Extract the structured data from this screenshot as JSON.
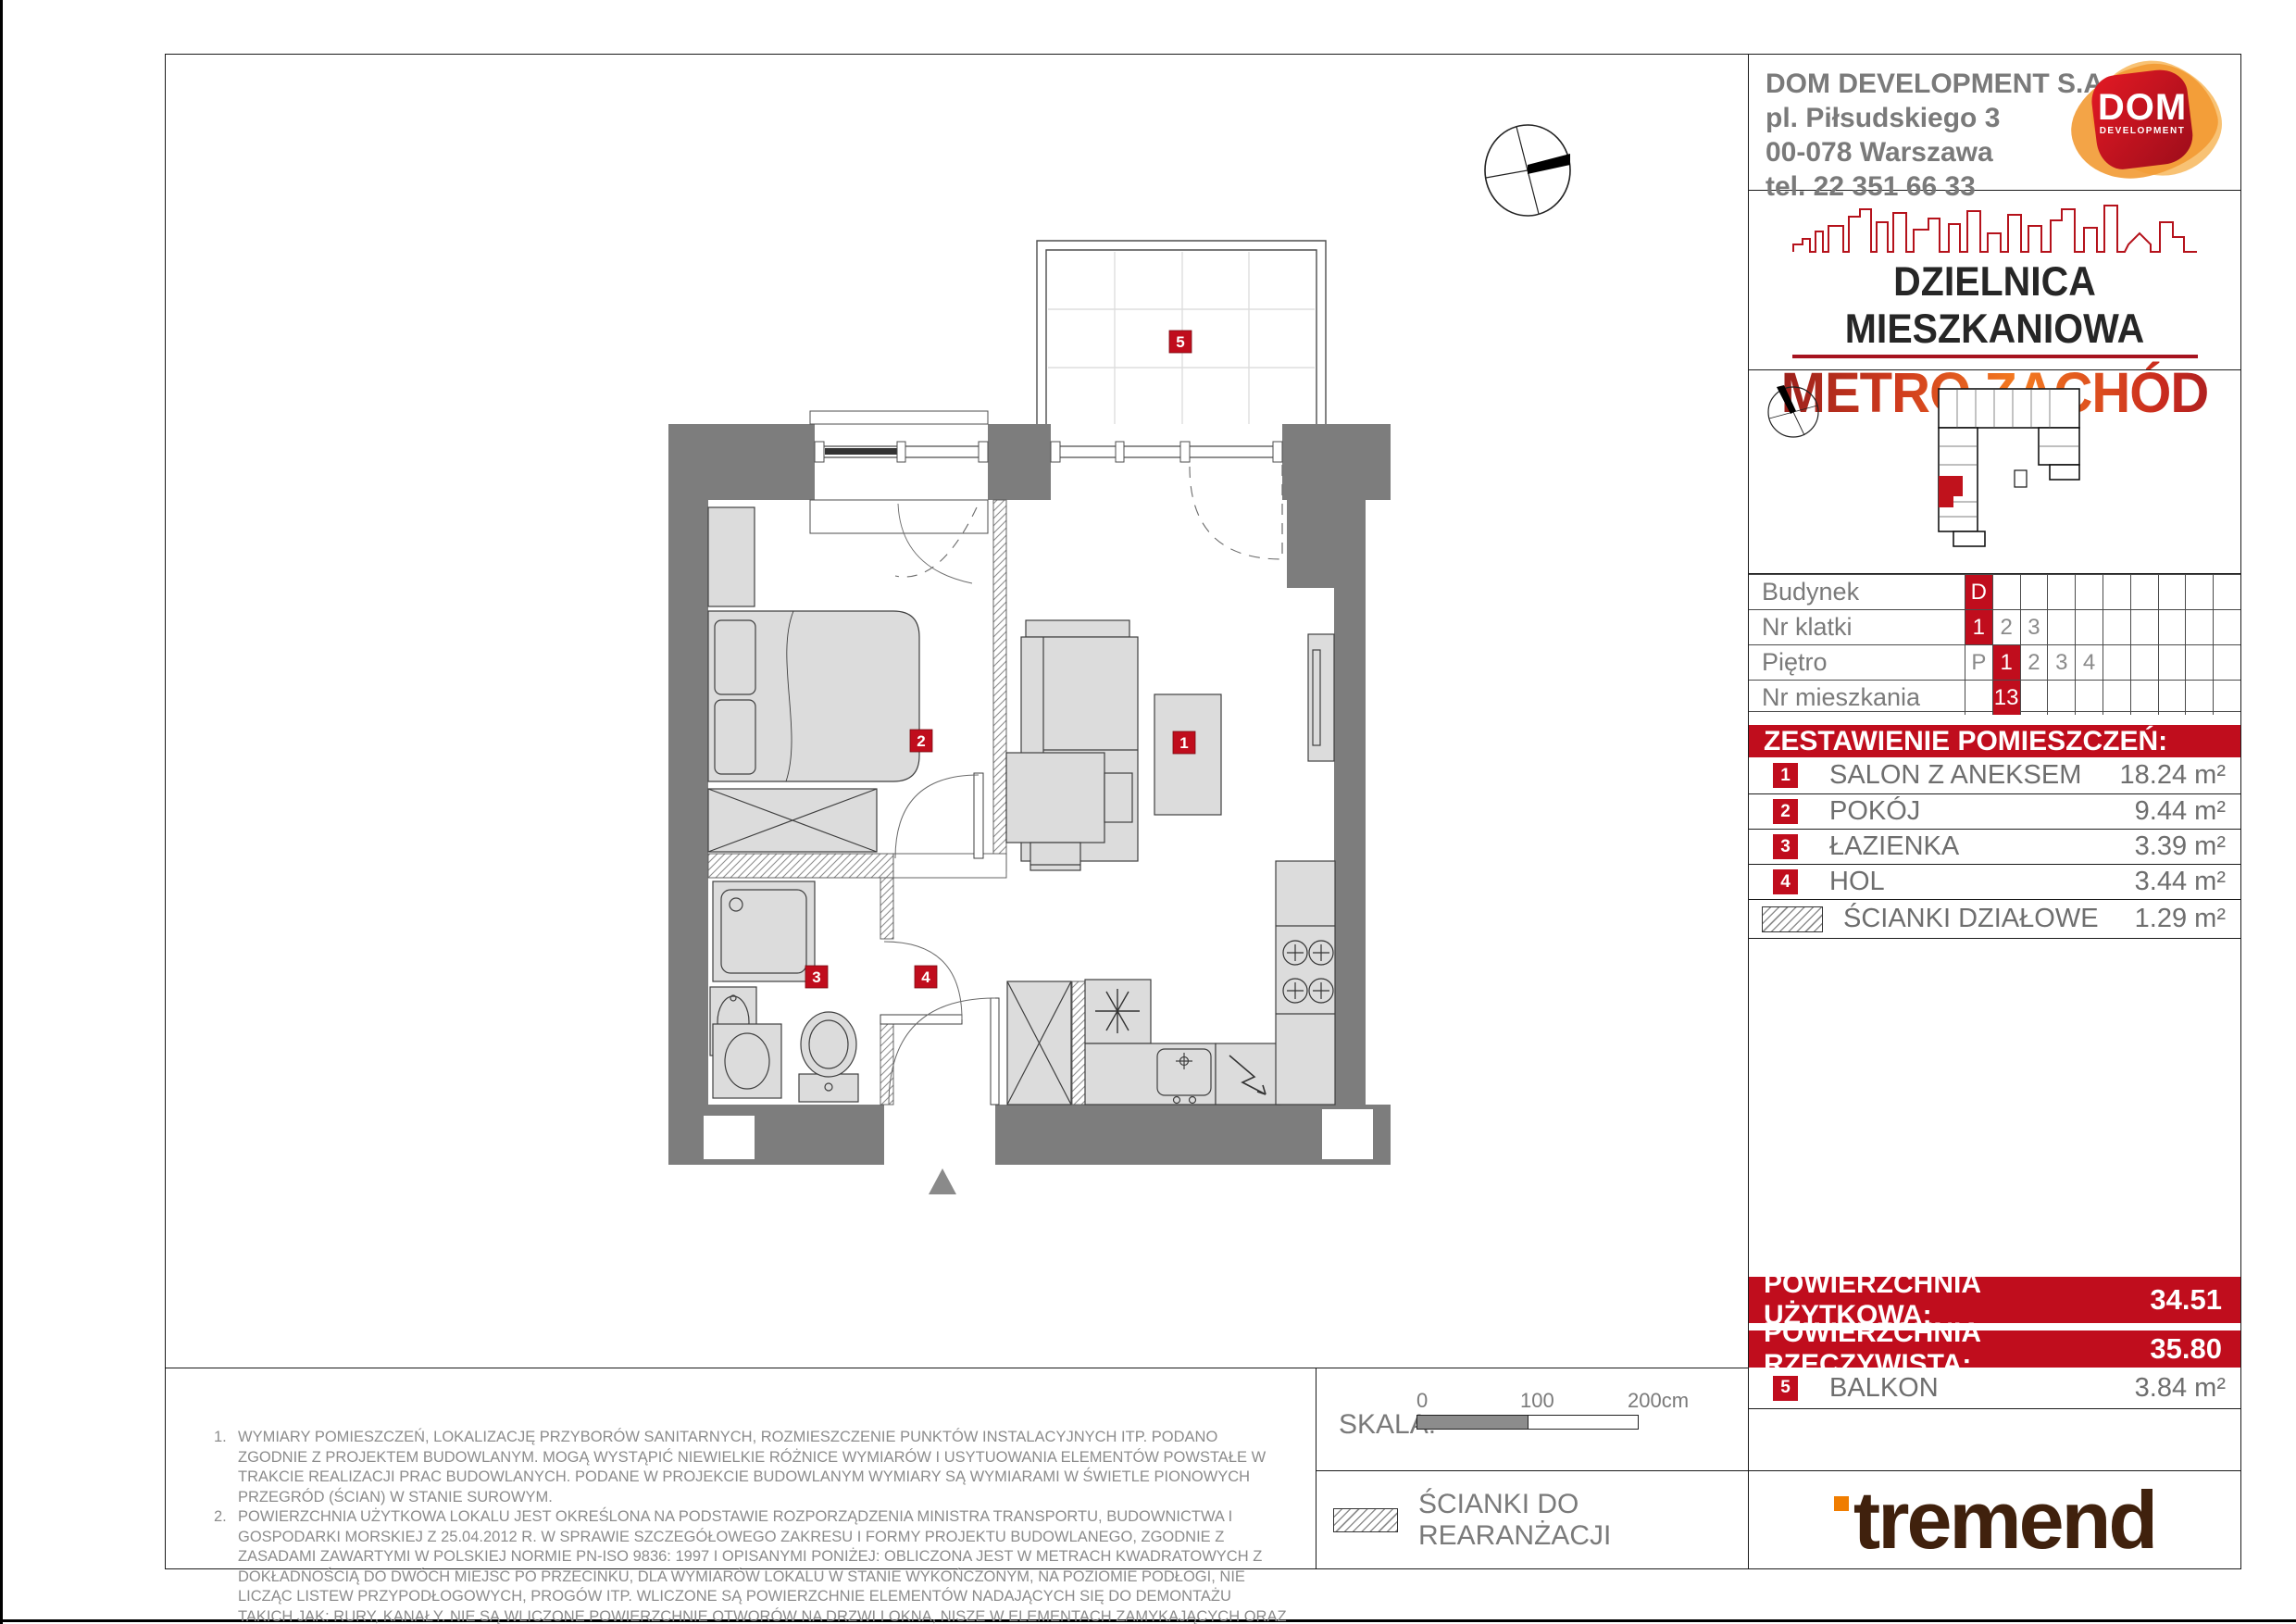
{
  "colors": {
    "accent_red": "#c00d1d",
    "orange": "#f07d00",
    "brand_brown": "#40210d",
    "wall_gray": "#7d7d7d"
  },
  "header": {
    "company": "DOM DEVELOPMENT S.A.",
    "address_line1": "pl. Piłsudskiego 3",
    "address_line2": "00-078 Warszawa",
    "phone": "tel. 22 351 66 33",
    "logo_text": "DOM",
    "logo_subtext": "DEVELOPMENT"
  },
  "branding": {
    "district_line": "DZIELNICA MIESZKANIOWA",
    "project_name": "METRO ZACHÓD"
  },
  "unit_table": {
    "rows": [
      {
        "label": "Budynek",
        "cells": [
          "D",
          "",
          "",
          "",
          "",
          "",
          "",
          "",
          "",
          ""
        ]
      },
      {
        "label": "Nr klatki",
        "cells": [
          "1",
          "2",
          "3",
          "",
          "",
          "",
          "",
          "",
          "",
          ""
        ]
      },
      {
        "label": "Piętro",
        "cells": [
          "P",
          "1",
          "2",
          "3",
          "4",
          "",
          "",
          "",
          "",
          ""
        ]
      },
      {
        "label": "Nr mieszkania",
        "cells": [
          "",
          "13",
          "",
          "",
          "",
          "",
          "",
          "",
          "",
          ""
        ]
      }
    ]
  },
  "rooms": {
    "header": "ZESTAWIENIE POMIESZCZEŃ:",
    "items": [
      {
        "no": "1",
        "name": "SALON Z ANEKSEM",
        "area": "18.24 m²"
      },
      {
        "no": "2",
        "name": "POKÓJ",
        "area": "9.44 m²"
      },
      {
        "no": "3",
        "name": "ŁAZIENKA",
        "area": "3.39 m²"
      },
      {
        "no": "4",
        "name": "HOL",
        "area": "3.44 m²"
      }
    ],
    "partition_row": {
      "name": "ŚCIANKI DZIAŁOWE",
      "area": "1.29 m²"
    }
  },
  "totals": {
    "usable_label": "POWIERZCHNIA UŻYTKOWA:",
    "usable_value": "34.51",
    "actual_label": "POWIERZCHNIA RZECZYWISTA:",
    "actual_value": "35.80"
  },
  "balcony_row": {
    "no": "5",
    "name": "BALKON",
    "area": "3.84 m²"
  },
  "scale_bar": {
    "label": "SKALA:",
    "tick_0": "0",
    "tick_100": "100",
    "tick_200": "200cm"
  },
  "legend": {
    "partition_label": "ŚCIANKI DO REARANŻACJI"
  },
  "notes": [
    {
      "num": "1.",
      "text": "WYMIARY POMIESZCZEŃ, LOKALIZACJĘ PRZYBORÓW SANITARNYCH, ROZMIESZCZENIE PUNKTÓW INSTALACYJNYCH ITP. PODANO ZGODNIE Z PROJEKTEM BUDOWLANYM. MOGĄ WYSTĄPIĆ NIEWIELKIE RÓŻNICE WYMIARÓW I USYTUOWANIA ELEMENTÓW POWSTAŁE W TRAKCIE REALIZACJI PRAC BUDOWLANYCH. PODANE W PROJEKCIE BUDOWLANYM WYMIARY SĄ WYMIARAMI W ŚWIETLE PIONOWYCH PRZEGRÓD (ŚCIAN) W STANIE SUROWYM."
    },
    {
      "num": "2.",
      "text": "POWIERZCHNIA UŻYTKOWA LOKALU JEST OKREŚLONA NA PODSTAWIE ROZPORZĄDZENIA MINISTRA TRANSPORTU, BUDOWNICTWA I GOSPODARKI MORSKIEJ Z 25.04.2012 R. W SPRAWIE SZCZEGÓŁOWEGO ZAKRESU I FORMY PROJEKTU BUDOWLANEGO, ZGODNIE Z ZASADAMI ZAWARTYMI W POLSKIEJ NORMIE PN-ISO 9836: 1997 I OPISANYMI PONIŻEJ: OBLICZONA JEST W METRACH KWADRATOWYCH Z DOKŁADNOŚCIĄ DO DWÓCH MIEJSC PO PRZECINKU, DLA WYMIARÓW LOKALU W STANIE WYKOŃCZONYM, NA POZIOMIE PODŁOGI, NIE LICZĄC LISTEW PRZYPODŁOGOWYCH, PROGÓW ITP. WLICZONE SĄ POWIERZCHNIE ELEMENTÓW NADAJĄCYCH SIĘ DO DEMONTAŻU TAKICH JAK: RURY, KANAŁY. NIE SĄ WLICZONE POWIERZCHNIE OTWORÓW NA DRZWI I OKNA, NISZE W ELEMENTACH ZAMYKAJĄCYCH ORAZ POWIERZCHNIE ZAJĘTE PRZEZ ŚCIANKI DZIAŁOWE."
    },
    {
      "num": "3.",
      "text": "PRZEDSTAWIONA NA RZUCIE ARANŻACJA MA CHARAKTER PRZYKŁADOWY, UMEBLOWANIE NIE STANOWI WYPOSAŻENIA NABYWANEGO LOKALU."
    }
  ],
  "footer": {
    "logo_text": "tremend"
  },
  "plan": {
    "room_labels": [
      "1",
      "2",
      "3",
      "4",
      "5"
    ]
  }
}
